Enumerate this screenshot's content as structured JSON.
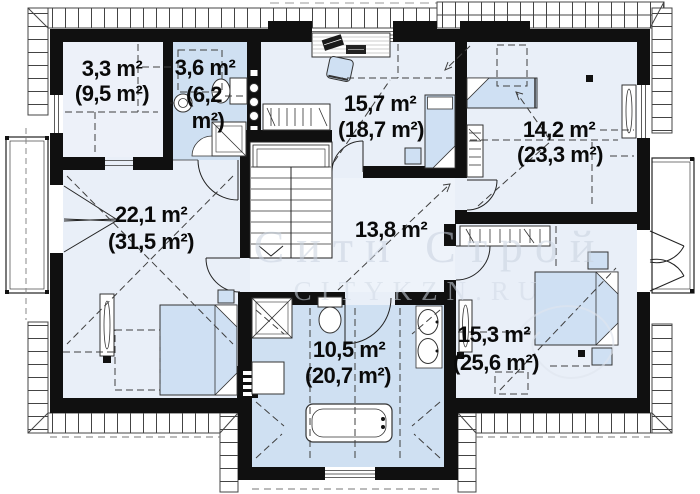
{
  "watermark": {
    "line1": "Сити Строй",
    "line2": "CITYKZN.RU"
  },
  "rooms": [
    {
      "id": "closet",
      "area": "3,3 m²",
      "total": "(9,5 m²)"
    },
    {
      "id": "bathroom-small",
      "area": "3,6 m²",
      "total_line1": "(6,2",
      "total_line2": "m²)"
    },
    {
      "id": "bedroom-top",
      "area": "15,7 m²",
      "total": "(18,7 m²)"
    },
    {
      "id": "bedroom-right",
      "area": "14,2 m²",
      "total": "(23,3 m²)"
    },
    {
      "id": "bedroom-left",
      "area": "22,1 m²",
      "total": "(31,5 m²)"
    },
    {
      "id": "hall",
      "area": "13,8 m²"
    },
    {
      "id": "bathroom-main",
      "area": "10,5 m²",
      "total": "(20,7 m²)"
    },
    {
      "id": "bedroom-bottom-right",
      "area": "15,3 m²",
      "total": "(25,6 m²)"
    }
  ],
  "colors": {
    "room_fill": "#e9eff8",
    "bath_fill": "#cfe0f2",
    "wall": "#101010",
    "furniture": "#cfe0f3"
  }
}
